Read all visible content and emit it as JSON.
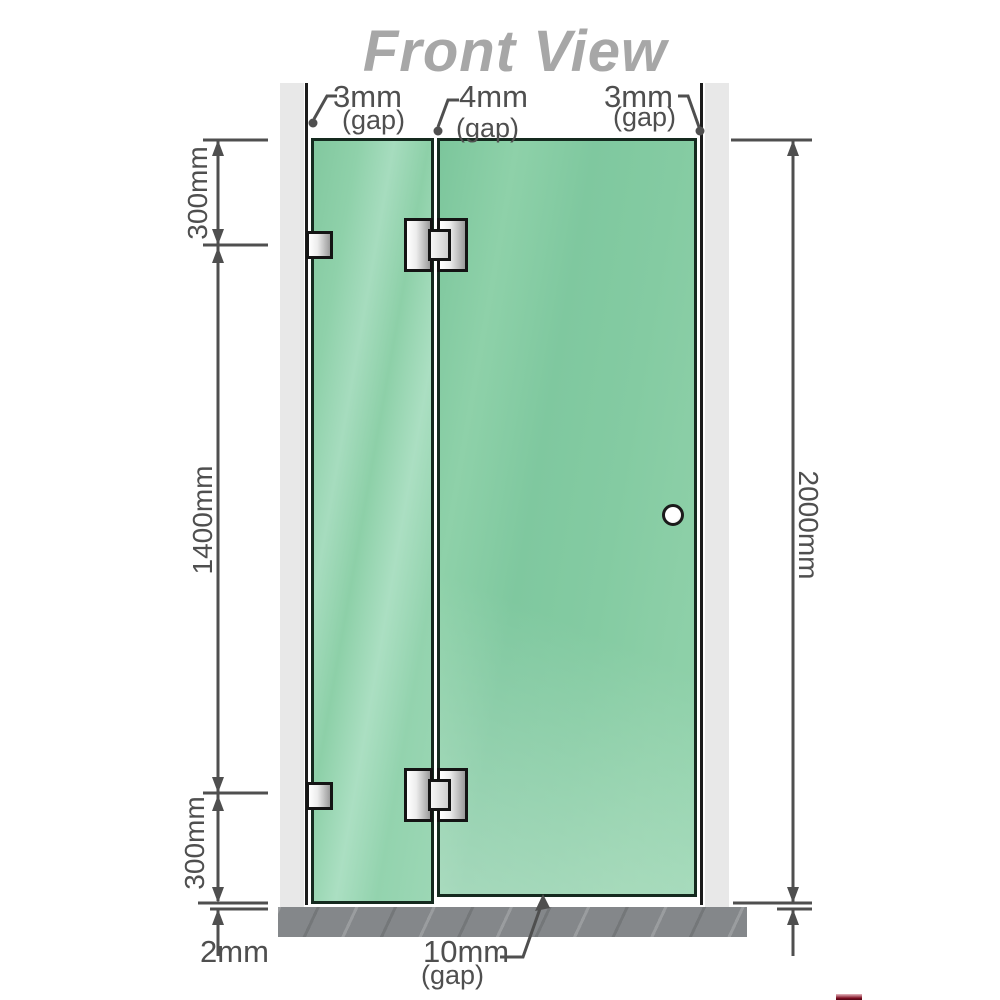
{
  "title": "Front View",
  "diagram": {
    "top_gaps": [
      {
        "value": "3mm",
        "suffix": "(gap)"
      },
      {
        "value": "4mm",
        "suffix": "(gap)"
      },
      {
        "value": "3mm",
        "suffix": "(gap)"
      }
    ],
    "left_dimensions": {
      "top": "300mm",
      "middle": "1400mm",
      "bottom": "300mm"
    },
    "right_dimension": "2000mm",
    "bottom_labels": {
      "floor_clearance": "2mm",
      "door_gap_value": "10mm",
      "door_gap_suffix": "(gap)"
    },
    "colors": {
      "glass": "#85cba4",
      "glass_highlight": "#a9dec0",
      "wall": "#e8e8e8",
      "floor": "#84878a",
      "dimension": "#4f4f4f",
      "title": "#a7a7a7"
    }
  }
}
